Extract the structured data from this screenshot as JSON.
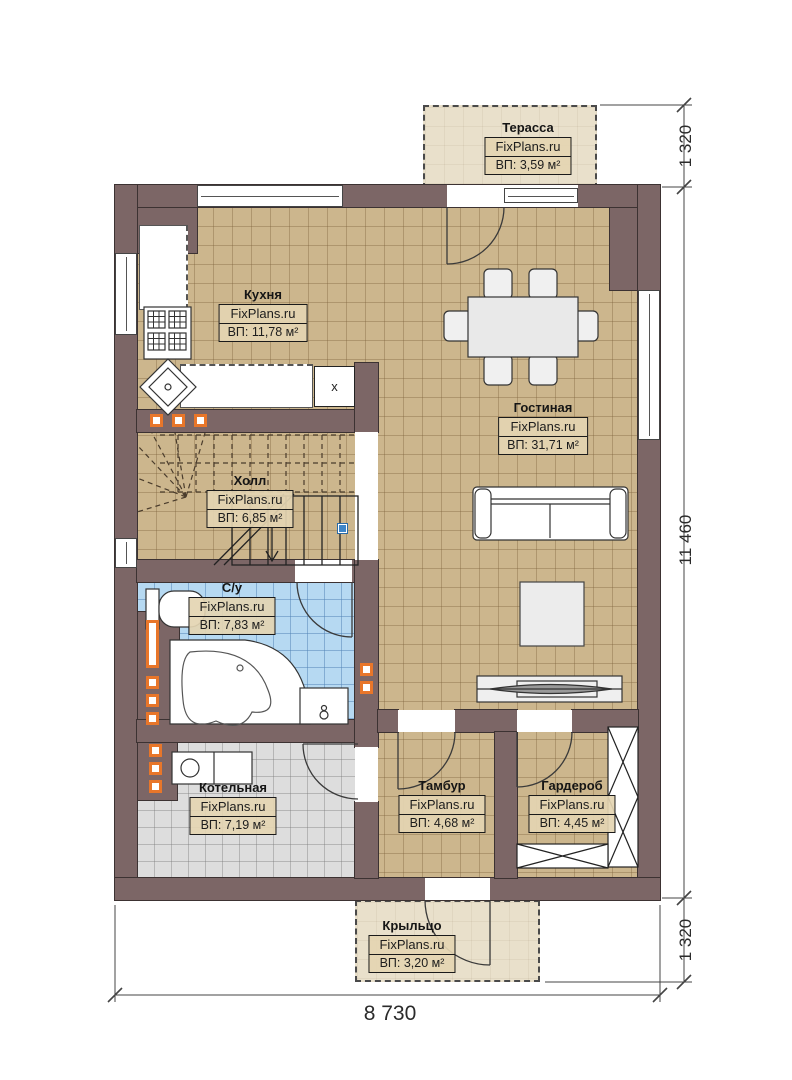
{
  "plan": {
    "watermark": "FixPlans.ru"
  },
  "rooms": {
    "terrace": {
      "name": "Терасса",
      "brand": "FixPlans.ru",
      "area": "ВП: 3,59 м²"
    },
    "kitchen": {
      "name": "Кухня",
      "brand": "FixPlans.ru",
      "area": "ВП: 11,78 м²"
    },
    "living": {
      "name": "Гостиная",
      "brand": "FixPlans.ru",
      "area": "ВП: 31,71 м²"
    },
    "hall": {
      "name": "Холл",
      "brand": "FixPlans.ru",
      "area": "ВП: 6,85 м²"
    },
    "bathroom": {
      "name": "С/у",
      "brand": "FixPlans.ru",
      "area": "ВП: 7,83 м²"
    },
    "boiler": {
      "name": "Котельная",
      "brand": "FixPlans.ru",
      "area": "ВП: 7,19 м²"
    },
    "tambour": {
      "name": "Тамбур",
      "brand": "FixPlans.ru",
      "area": "ВП: 4,68 м²"
    },
    "wardrobe": {
      "name": "Гардероб",
      "brand": "FixPlans.ru",
      "area": "ВП: 4,45 м²"
    },
    "porch": {
      "name": "Крыльцо",
      "brand": "FixPlans.ru",
      "area": "ВП: 3,20 м²"
    }
  },
  "dimensions": {
    "right_top": "1 320",
    "right_side": "11 460",
    "right_bottom": "1 320",
    "bottom_width": "8 730"
  },
  "markers": {
    "kitchen_cabinet": "x"
  },
  "colors": {
    "wall": "#7c6666",
    "wall_edge": "#3c3232",
    "floor_beige": "#ccb68d",
    "floor_blue": "#b6d9f2",
    "floor_gray": "#dddddd",
    "outdoor": "#e9e0cb",
    "accent_orange": "#e8762a",
    "handle_blue": "#3d85c8"
  }
}
